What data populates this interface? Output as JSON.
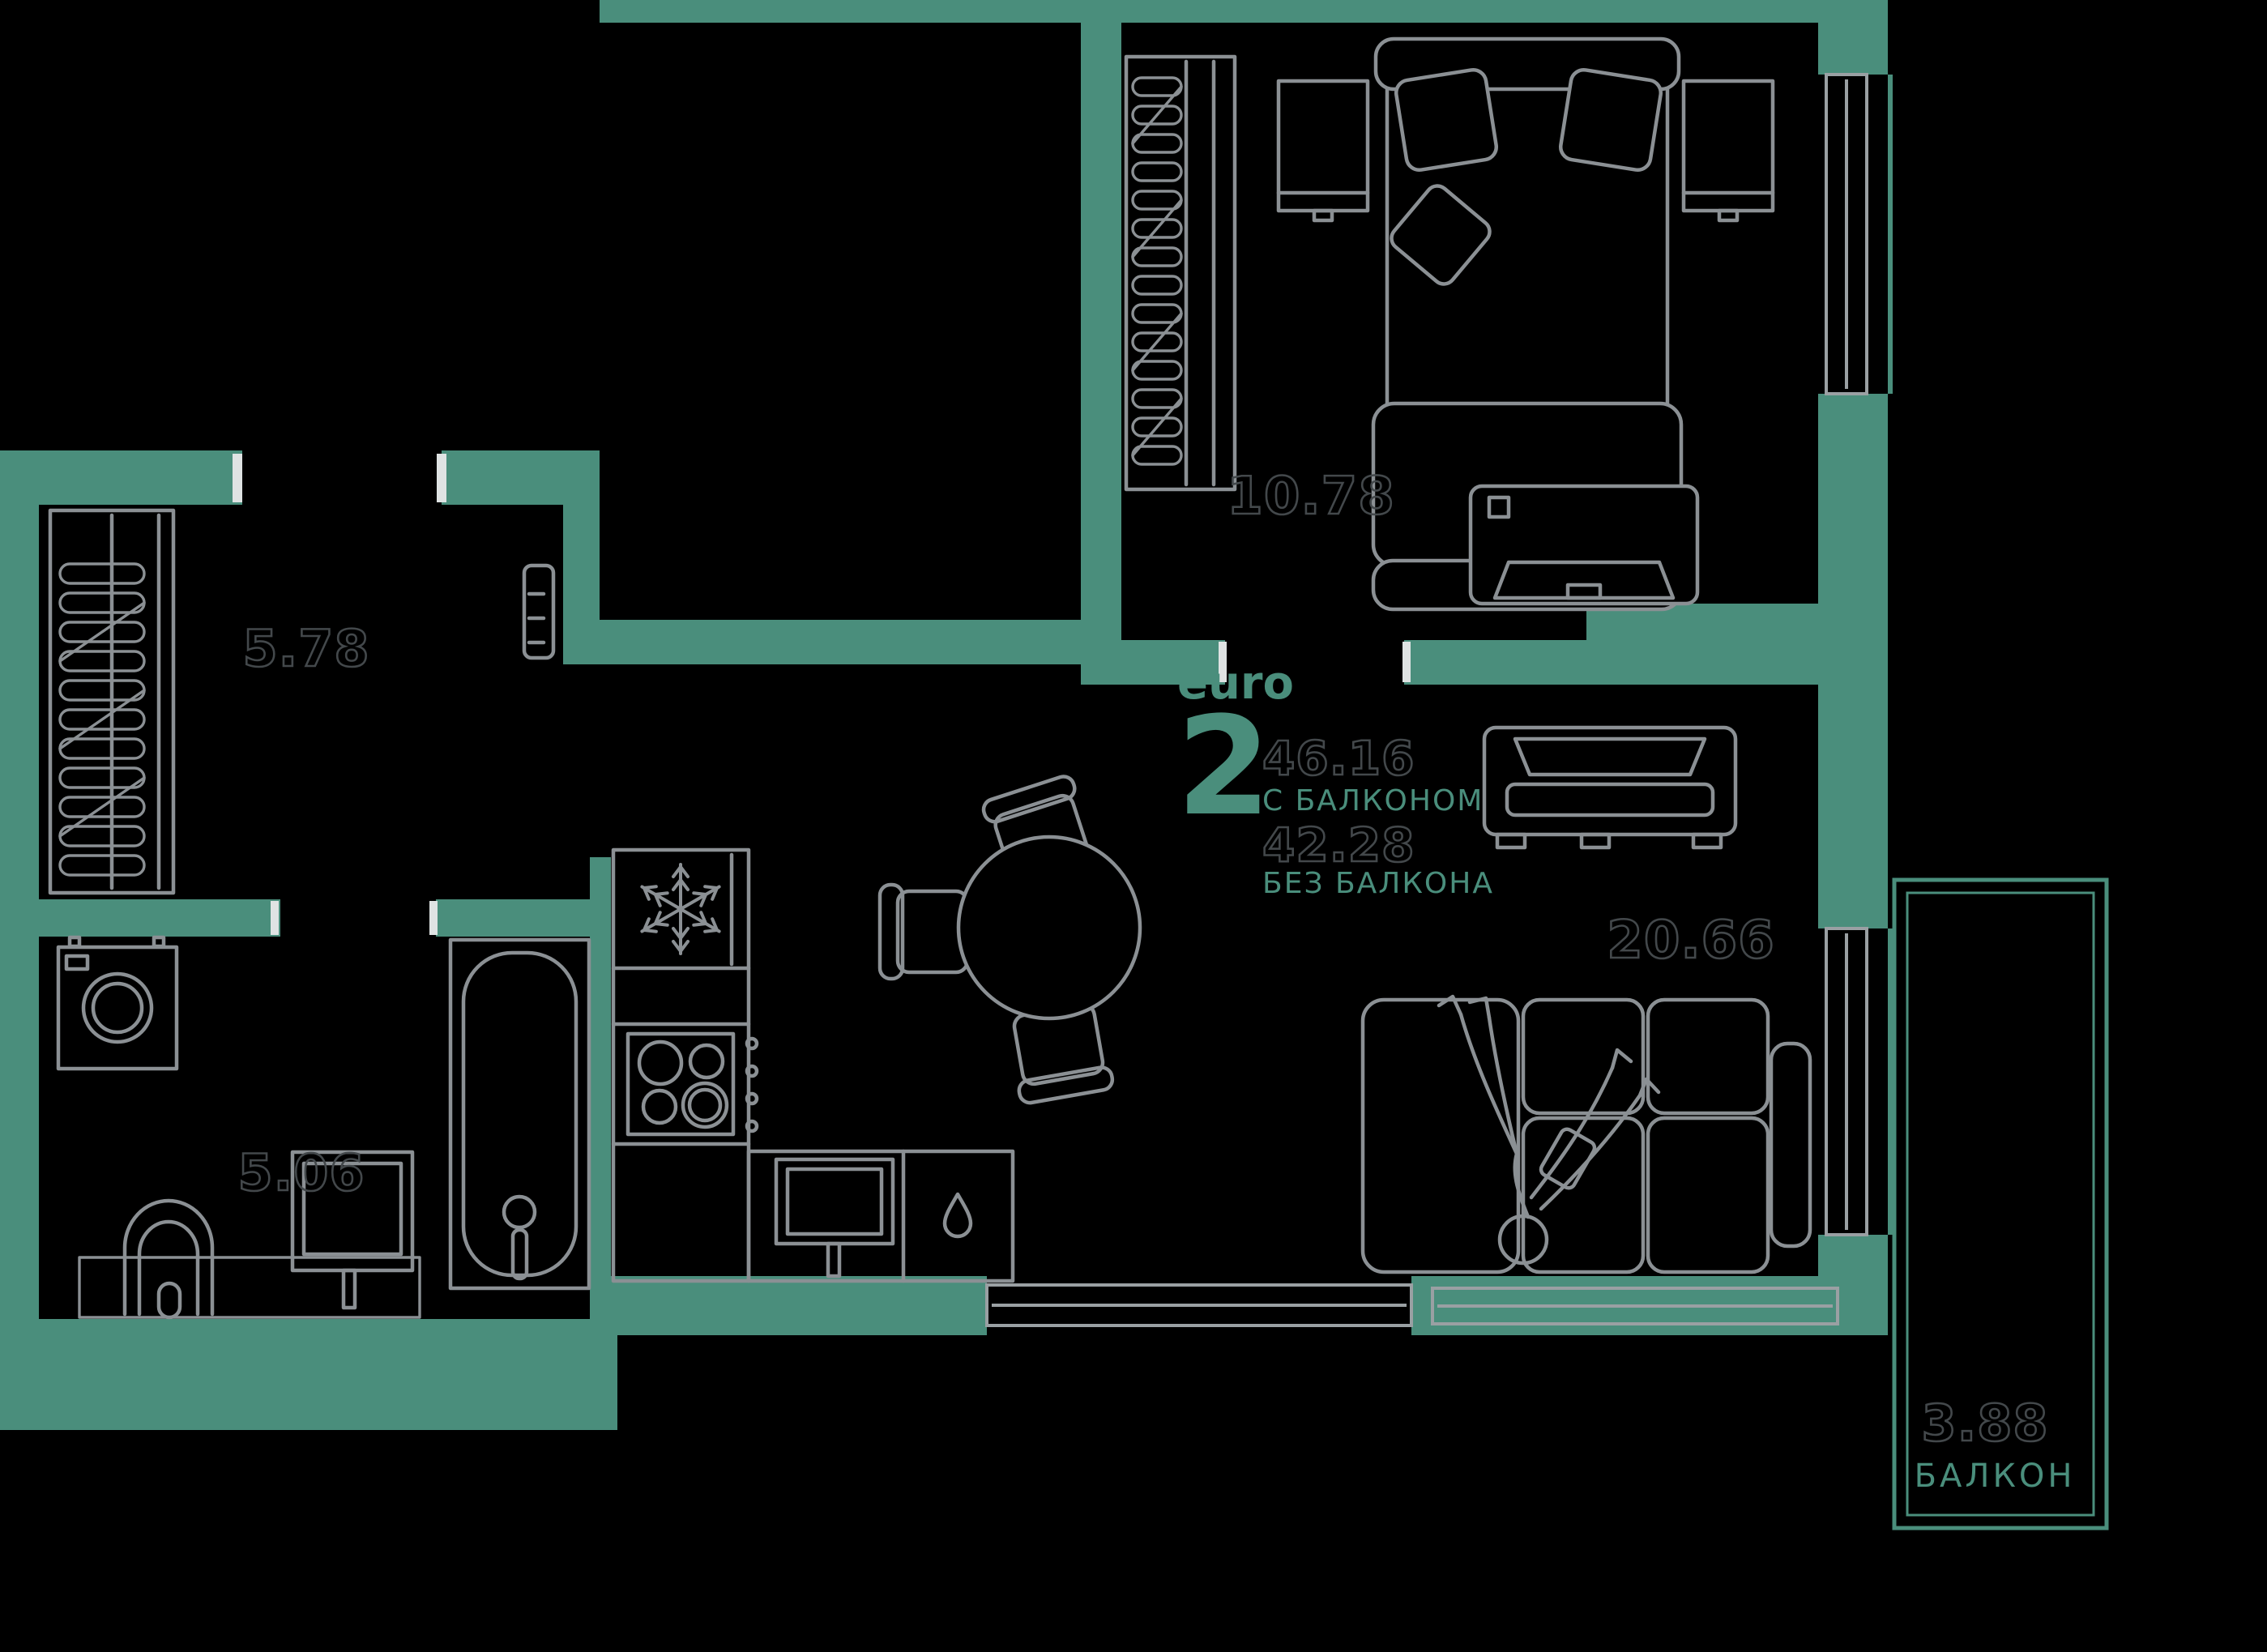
{
  "title": "Apartment floor plan",
  "colors": {
    "background": "#000000",
    "wall": "#4a8e7c",
    "line": "#8b9094",
    "window_line": "#9aa0a3",
    "num_stroke": "#43484b",
    "jamb": "#dfe3e3"
  },
  "legend": {
    "euro_label": "euro",
    "rooms_count": "2",
    "area_with_balcony": "46.16",
    "with_balcony_label": "С БАЛКОНОМ",
    "area_without_balcony": "42.28",
    "without_balcony_label": "БЕЗ БАЛКОНА"
  },
  "rooms": {
    "hallway": {
      "area": "5.78"
    },
    "bedroom": {
      "area": "10.78"
    },
    "bathroom": {
      "area": "5.06"
    },
    "living_kitchen": {
      "area": "20.66"
    },
    "balcony": {
      "area": "3.88",
      "label": "БАЛКОН"
    }
  },
  "icons": {
    "fridge": "snowflake-icon",
    "sink_cabinet": "water-drop-icon"
  }
}
